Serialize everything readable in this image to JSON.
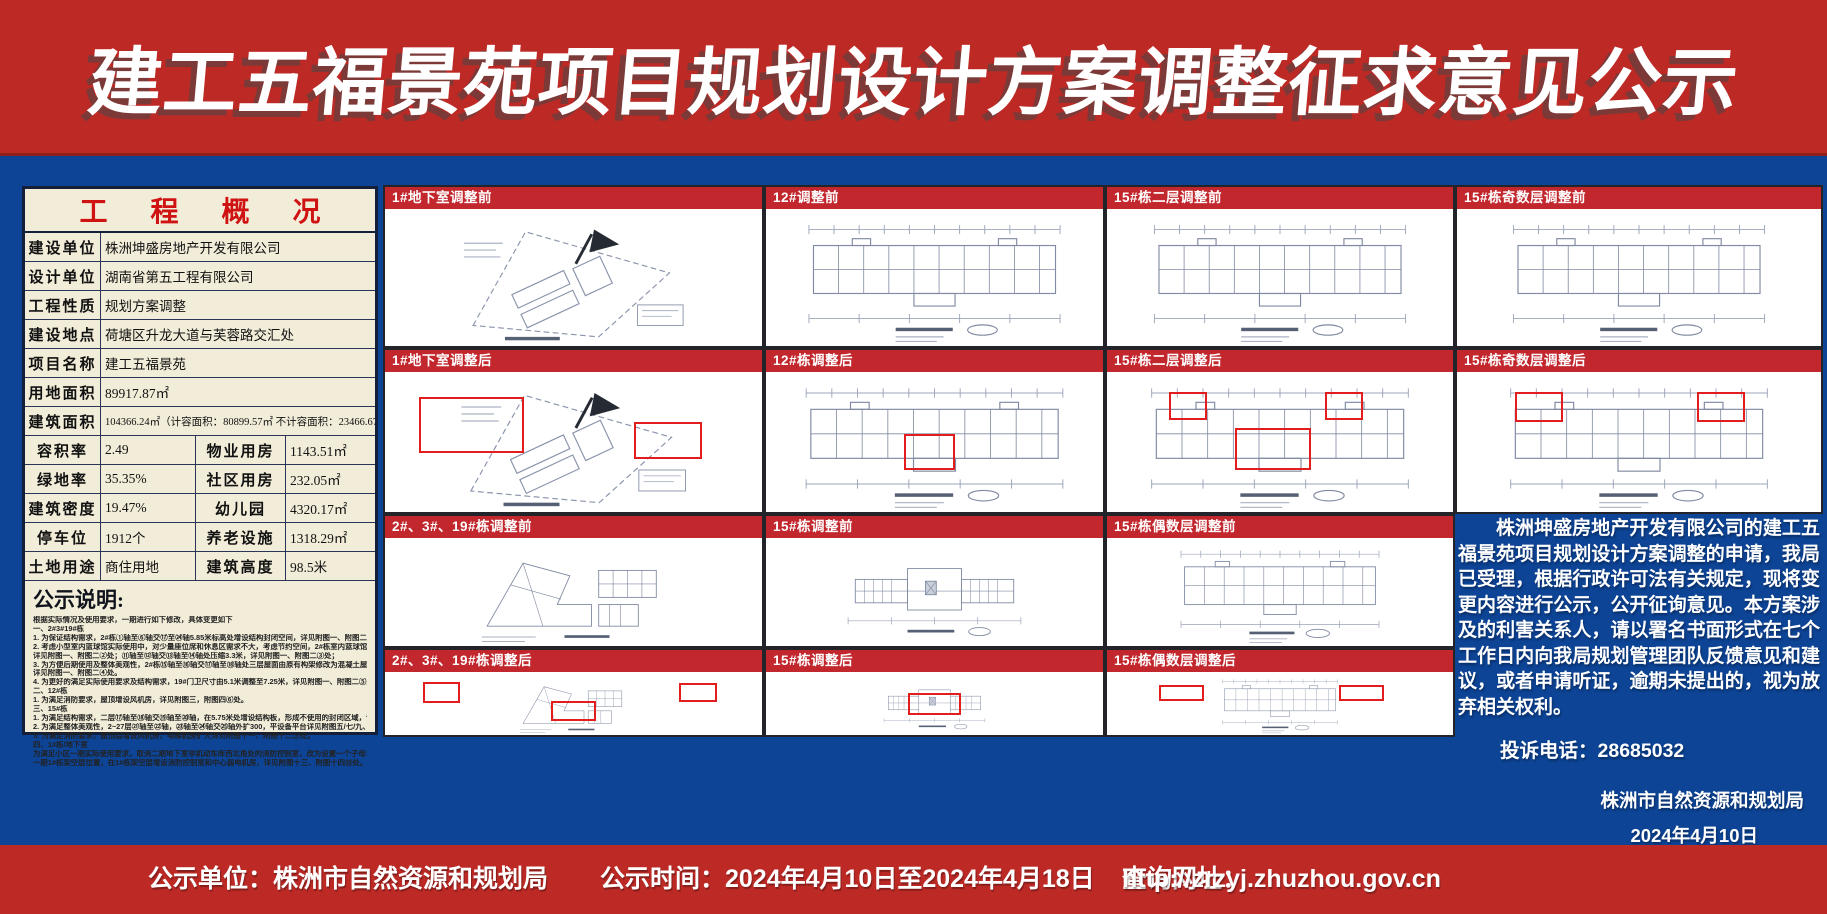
{
  "colors": {
    "banner_red": "#bd2a26",
    "background_blue": "#0d4496",
    "panel_cream": "#f2edd9",
    "plan_label_red": "#c1272d",
    "highlight_red": "#e21d1d",
    "overview_title_red": "#cf1313"
  },
  "icons": {
    "north_arrow": "north-arrow-icon"
  },
  "header": {
    "title": "建工五福景苑项目规划设计方案调整征求意见公示"
  },
  "overview": {
    "title": "工  程  概  况",
    "rows_full": [
      {
        "label": "建设单位",
        "value": "株洲坤盛房地产开发有限公司"
      },
      {
        "label": "设计单位",
        "value": "湖南省第五工程有限公司"
      },
      {
        "label": "工程性质",
        "value": "规划方案调整"
      },
      {
        "label": "建设地点",
        "value": "荷塘区升龙大道与芙蓉路交汇处"
      },
      {
        "label": "项目名称",
        "value": "建工五福景苑"
      },
      {
        "label": "用地面积",
        "value": "89917.87㎡"
      },
      {
        "label": "建筑面积",
        "value": "104366.24㎡（计容面积：80899.57㎡ 不计容面积：23466.67㎡）"
      }
    ],
    "rows_split": [
      {
        "l1": "容积率",
        "v1": "2.49",
        "l2": "物业用房",
        "v2": "1143.51㎡"
      },
      {
        "l1": "绿地率",
        "v1": "35.35%",
        "l2": "社区用房",
        "v2": "232.05㎡"
      },
      {
        "l1": "建筑密度",
        "v1": "19.47%",
        "l2": "幼儿园",
        "v2": "4320.17㎡"
      },
      {
        "l1": "停车位",
        "v1": "1912个",
        "l2": "养老设施",
        "v2": "1318.29㎡"
      },
      {
        "l1": "土地用途",
        "v1": "商住用地",
        "l2": "建筑高度",
        "v2": "98.5米"
      }
    ],
    "notes_title": "公示说明:",
    "notes": [
      "根据实际情况及使用要求，一期进行如下修改，具体变更如下",
      "一、2#3#19#栋",
      "1. 为保证结构需求，2#栋①轴至⑥轴交⑰至㉔轴5.85米标高处增设结构封闭空间，详见附图一、附图二①处。",
      "2. 考虑小型室内篮球馆实际使用中，对少量座位席和休息区需求不大，考虑节约空间，2#栋室内篮球馆⑪轴外扩3.4米，",
      "详见附图一、附图二②处；⑪轴至⑫轴交⑬轴至⑭轴处压缩3.3米，详见附图一、附图二③处；",
      "3. 为方便后期使用及整体美观性，2#栋⑮轴至⑯轴交⑰轴至⑱轴处三层屋面由原有构架修改为混凝土屋面。",
      "详见附图一、附图二④处。",
      "4. 为更好的满足实际使用要求及结构需求，19#门卫尺寸由5.1米调整至7.25米，详见附图一、附图二⑤处。",
      "二、12#栋",
      "1. 为满足消防要求，屋顶增设风机房，详见附图三，附图四⑥处。",
      "三、15#栋",
      "1. 为满足结构需求，二层⑰轴至⑱轴交⑲轴至⑳轴，在5.75米处增设结构板，形成不使用的封闭区域，详见附图五、",
      "2. 为满足整体美观性，2~27层㉑轴至㉒轴，㉓轴至㉔轴交㉕轴外扩300，平设备平台详见附图五/七/九、附图六/八/",
      "3. 为满足消防要求，屋顶层增设风机房，电梯机房扩大详见附图十一、附图十二⑨处。",
      "四、1#栋/地下室",
      "为满足小区一期实际使用要求，取消二期地下室非机动车库西北角处的消防控制室，改为设置一个子母车位；将消防控制",
      "一期1#栋架空层位置，在1#栋架空层增设消防控制室和中心弱电机房，详见附图十三、附图十四⑩处。"
    ]
  },
  "plans": {
    "row1": [
      "1#地下室调整前",
      "12#调整前",
      "15#栋二层调整前",
      "15#栋奇数层调整前"
    ],
    "row2": [
      "1#地下室调整后",
      "12#栋调整后",
      "15#栋二层调整后",
      "15#栋奇数层调整后"
    ],
    "row3": [
      "2#、3#、19#栋调整前",
      "15#栋调整前",
      "15#栋偶数层调整前"
    ],
    "row4": [
      "2#、3#、19#栋调整后",
      "15#栋调整后",
      "15#栋偶数层调整后"
    ]
  },
  "notice": {
    "paragraph": "株洲坤盛房地产开发有限公司的建工五福景苑项目规划设计方案调整的申请，我局已受理，根据行政许可法有关规定，现将变更内容进行公示，公开征询意见。本方案涉及的利害关系人，请以署名书面形式在七个工作日内向我局规划管理团队反馈意见和建议，或者申请听证，逾期未提出的，视为放弃相关权利。",
    "phone_label": "投诉电话：",
    "phone_number": "28685032",
    "agency": "株洲市自然资源和规划局",
    "date": "2024年4月10日"
  },
  "footer": {
    "unit": "公示单位：株洲市自然资源和规划局",
    "time": "公示时间：2024年4月10日至2024年4月18日",
    "url_label": "查询网址：",
    "url": "http://zrzyj.zhuzhou.gov.cn"
  }
}
